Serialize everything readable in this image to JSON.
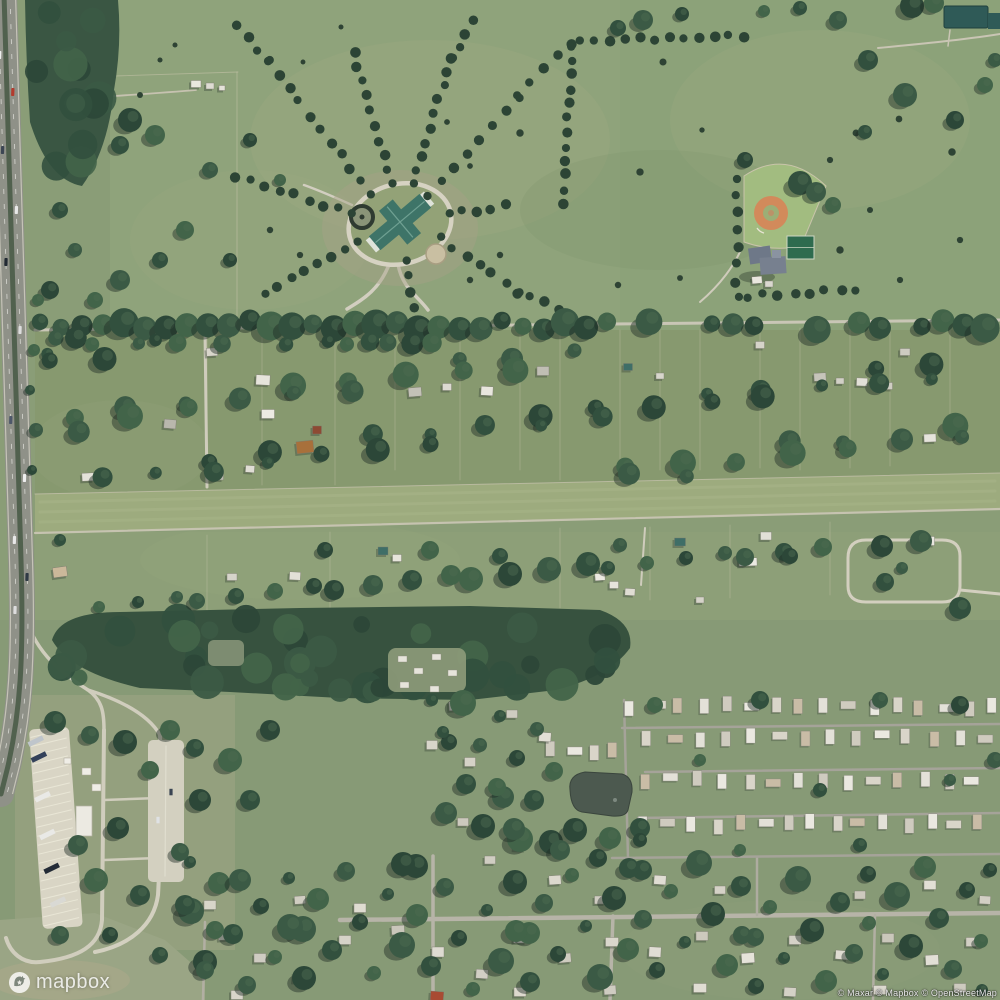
{
  "map": {
    "type": "satellite-aerial-imagery",
    "description": "Aerial view: divided highway along west edge, estate with radiating tree-lined lanes and oval drive, baseball diamond with sport court, tree-lined road, rural parcels, grass airstrip, highway rest area with angled truck parking, pond, mobile-home park and suburban streets"
  },
  "overlay": {
    "logo_text": "mapbox",
    "attribution": "© Maxar © Mapbox © OpenStreetMap"
  },
  "colors": {
    "field_base": "#8a9d77",
    "forest": "#37523f",
    "road_light": "#cfccbc",
    "highway_gray": "#8f9188",
    "highway_median": "#51614e",
    "clay_infield": "#d28a5b",
    "pond_water": "#4c594f",
    "teal_roof": "#3e7468",
    "home_white": "#eae8e0",
    "concrete": "#d9d5c5"
  }
}
